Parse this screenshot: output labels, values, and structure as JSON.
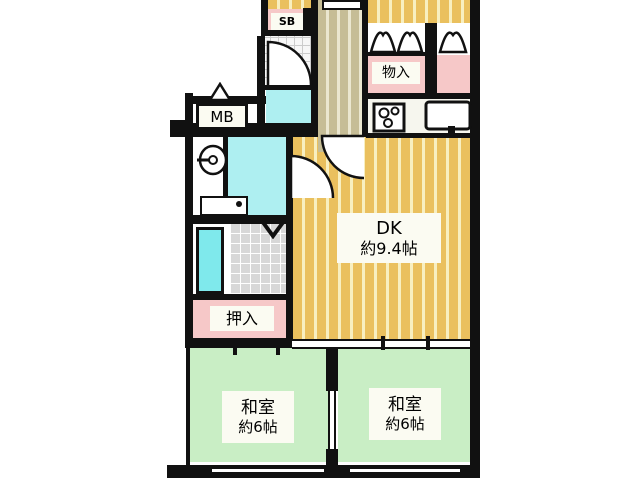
{
  "plan": {
    "title": "apartment floor plan",
    "rooms": {
      "sb": {
        "label": "SB"
      },
      "mb": {
        "label": "MB"
      },
      "storage": {
        "label": "物入"
      },
      "dk": {
        "label": "DK",
        "size": "約9.4帖"
      },
      "oshiire": {
        "label": "押入"
      },
      "washitsu_left": {
        "label": "和室",
        "size": "約6帖"
      },
      "washitsu_right": {
        "label": "和室",
        "size": "約6帖"
      }
    },
    "icons": {
      "stove": "stove-burners-icon (square with 3 circles)",
      "sink": "kitchen-sink-icon (rounded rect with drain tab)",
      "washer": "washing-machine-icon (circle with stem)",
      "bathtub": "bathtub-icon (cyan outlined rect)",
      "door_marker": "triangle-door-marker-icon",
      "folding_door": "folding-closet-door-icon (M curves)",
      "swing_door": "quarter-circle-door-arc"
    },
    "palette": {
      "wall": "#111111",
      "tatami_green": "#c9eec5",
      "closet_pink": "#f6c8c8",
      "flooring_orange": "#eac05e",
      "flooring_orange_light": "#f8efc0",
      "corridor_tan": "#c6bd96",
      "corridor_tan_light": "#ebe7d0",
      "water_cyan": "#7fe9ec",
      "water_cyan_light": "#aeeff1",
      "tile_gray": "#d8d8d8",
      "label_bg": "#fbfbf2"
    }
  }
}
